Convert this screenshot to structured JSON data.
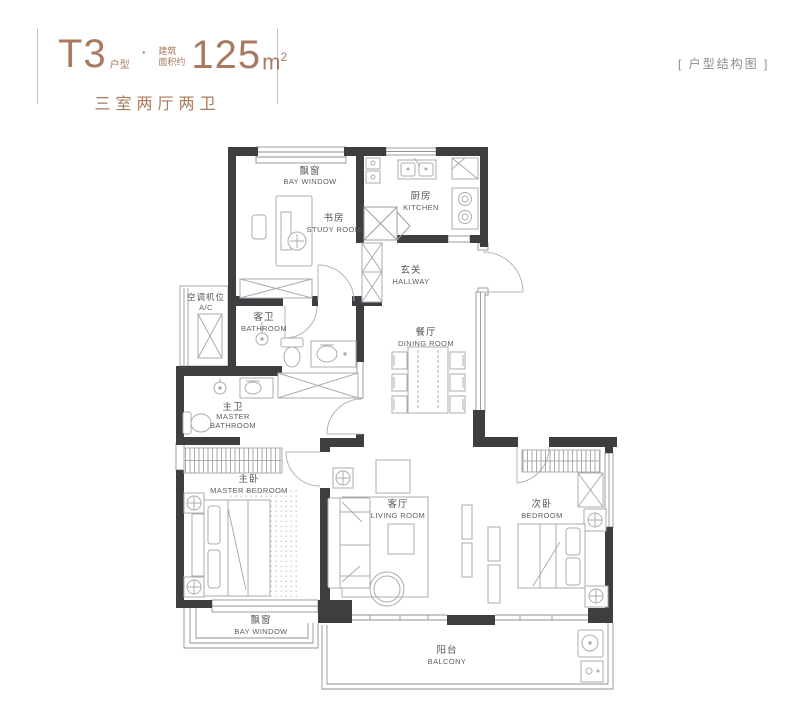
{
  "header": {
    "type_code": "T3",
    "type_label": "户型",
    "dot": "·",
    "area_label_line1": "建筑",
    "area_label_line2": "面积约",
    "area_value": "125",
    "area_unit": "m",
    "area_exponent": "2",
    "layout_summary": "三室两厅两卫"
  },
  "corner_note": "[ 户型结构图 ]",
  "rooms": {
    "bay_window_top": {
      "zh": "飘窗",
      "en": "BAY WINDOW"
    },
    "study": {
      "zh": "书房",
      "en": "STUDY ROOM"
    },
    "kitchen": {
      "zh": "厨房",
      "en": "KITCHEN"
    },
    "hallway": {
      "zh": "玄关",
      "en": "HALLWAY"
    },
    "ac_platform": {
      "zh": "空调机位",
      "en": "A/C"
    },
    "bathroom": {
      "zh": "客卫",
      "en": "BATHROOM"
    },
    "dining_room": {
      "zh": "餐厅",
      "en": "DINING ROOM"
    },
    "master_bathroom": {
      "zh": "主卫",
      "en_line1": "MASTER",
      "en_line2": "BATHROOM"
    },
    "master_bedroom": {
      "zh": "主卧",
      "en": "MASTER BEDROOM"
    },
    "living_room": {
      "zh": "客厅",
      "en": "LIVING ROOM"
    },
    "bedroom": {
      "zh": "次卧",
      "en": "BEDROOM"
    },
    "bay_window_bottom": {
      "zh": "飘窗",
      "en": "BAY WINDOW"
    },
    "balcony": {
      "zh": "阳台",
      "en": "BALCONY"
    }
  },
  "colors": {
    "accent": "#a87a5f",
    "wall": "#3e3e41",
    "furniture_line": "#a8adb2",
    "label": "#53575a",
    "note": "#8c8c8c"
  }
}
